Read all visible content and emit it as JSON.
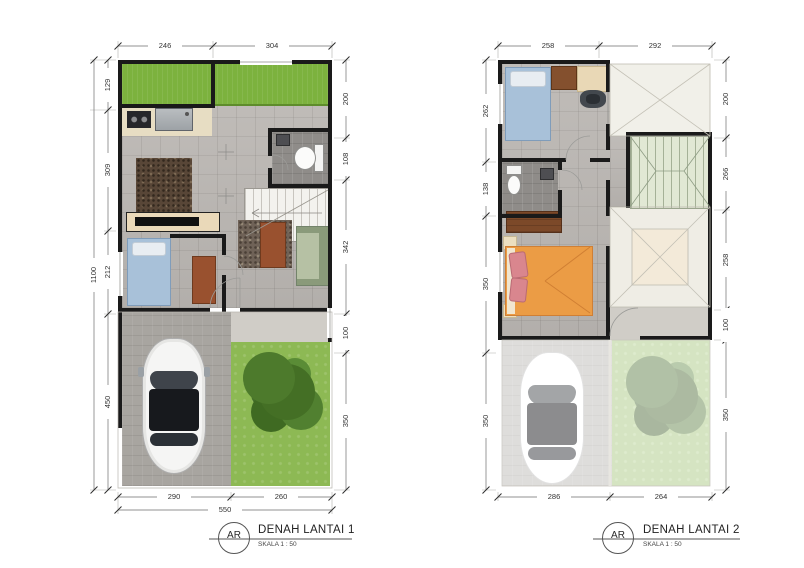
{
  "sheet": {
    "background": "#ffffff",
    "drawing_type": "architectural floor plan"
  },
  "plans": [
    {
      "title": "DENAH LANTAI 1",
      "scale_label": "SKALA 1 : 50",
      "badge": "AR",
      "dims": {
        "top": [
          "246",
          "304"
        ],
        "bottom": [
          "290",
          "260"
        ],
        "bottom_total": "550",
        "left": [
          "129",
          "309",
          "212",
          "450"
        ],
        "left_total": "1100",
        "right": [
          "200",
          "108",
          "342",
          "100",
          "350"
        ]
      }
    },
    {
      "title": "DENAH LANTAI 2",
      "scale_label": "SKALA 1 : 50",
      "badge": "AR",
      "dims": {
        "top": [
          "258",
          "292"
        ],
        "bottom": [
          "286",
          "264"
        ],
        "left": [
          "262",
          "138",
          "350",
          "350"
        ],
        "right": [
          "200",
          "266",
          "258",
          "100",
          "350"
        ]
      }
    }
  ],
  "colors": {
    "wall": "#1a1a1a",
    "grass": "#7cb23e",
    "garden": "#8db954",
    "floor_tile": "#bcb8b4",
    "bath_floor": "#8f8c89",
    "paving": "#a8a5a0",
    "bed_blue": "#a8c1d9",
    "bed_orange": "#eb9c45",
    "pillow_pink": "#d9868e",
    "sofa_green": "#8a9a7a",
    "table_rust": "#99512f",
    "wood_brown": "#7c4929",
    "counter_cream": "#e7ddc3",
    "roof_panel": "#f1f0e9",
    "stair_void_green": "#e1e8d4",
    "dimension_text": "#333333"
  },
  "icons": {
    "car": "car-top-view-icon",
    "tree": "tree-canopy-icon",
    "toilet": "toilet-icon",
    "sink": "sink-icon",
    "stove": "stove-burners-icon",
    "badge": "title-badge-circle"
  }
}
